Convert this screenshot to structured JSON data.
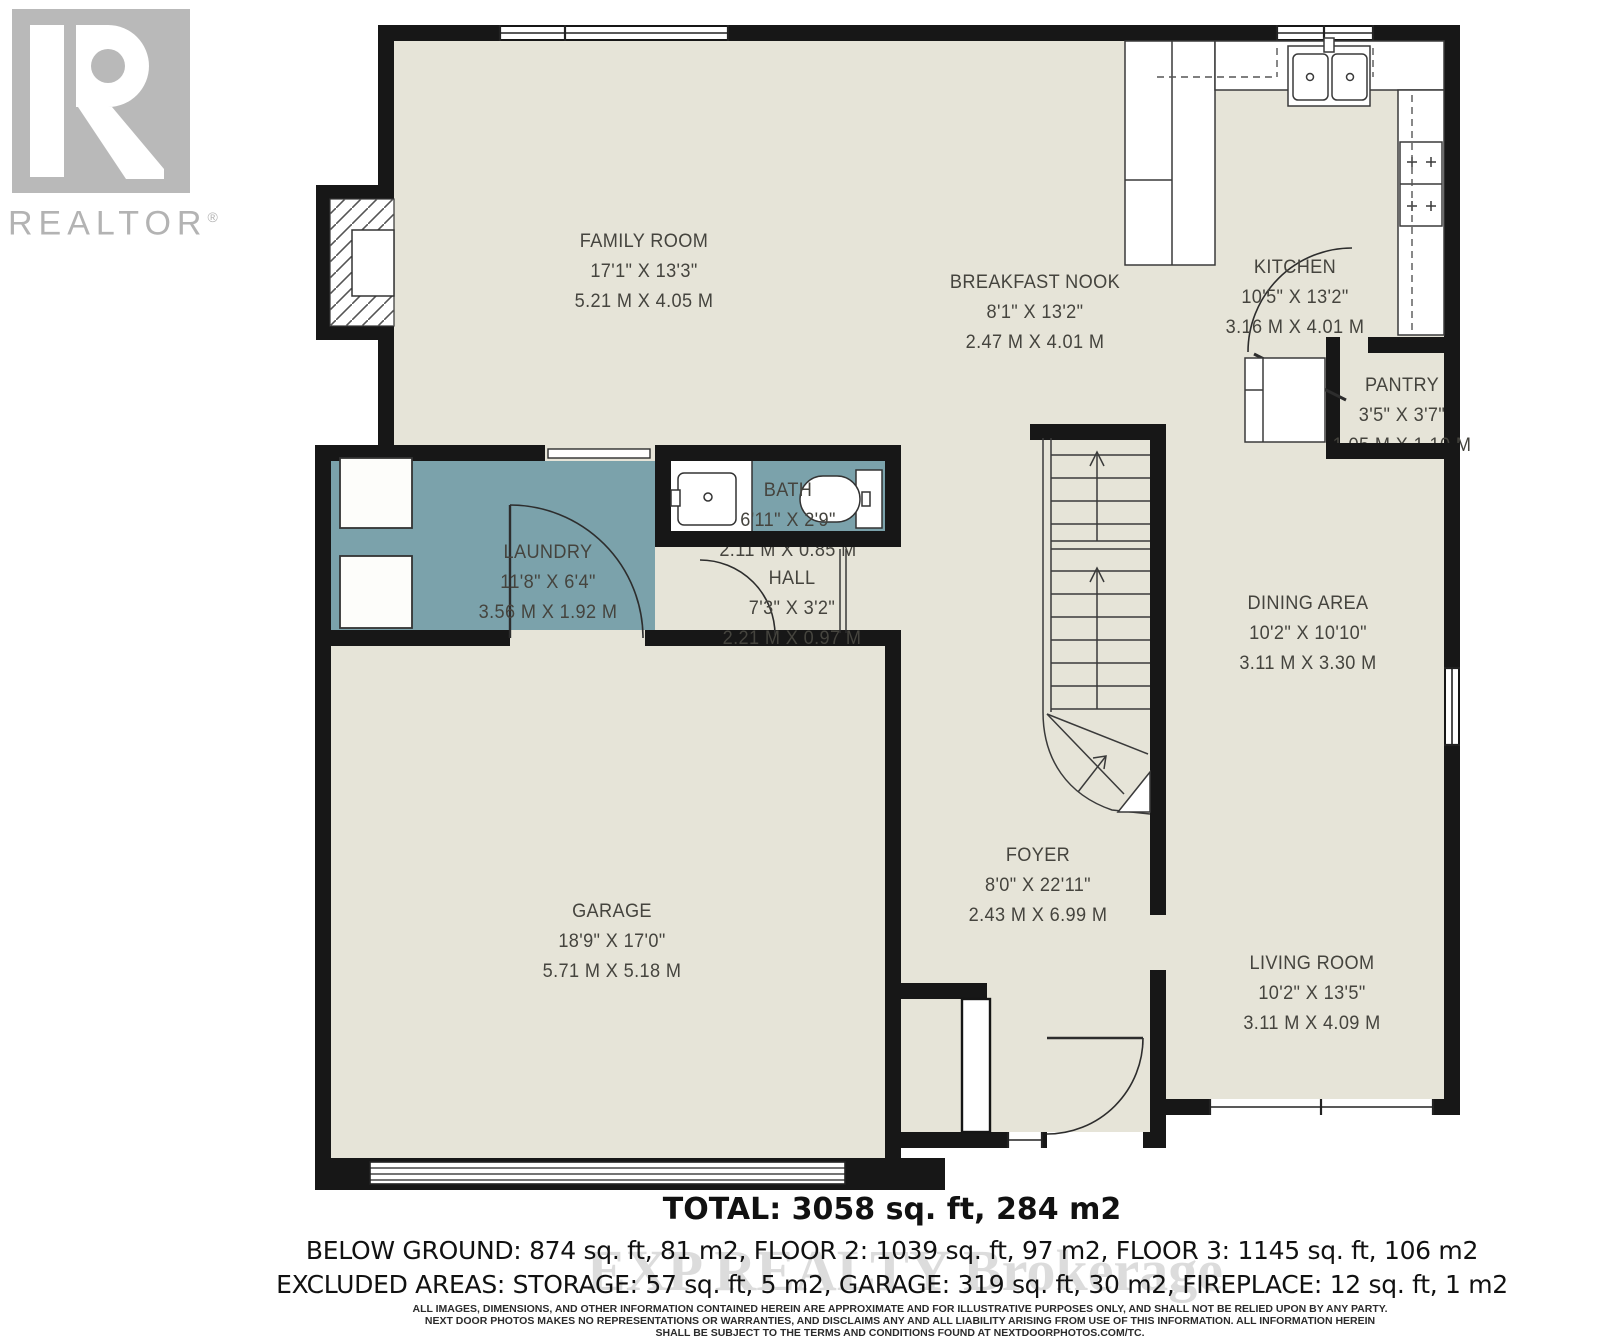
{
  "branding": {
    "logo_text": "REALTOR",
    "registered_mark": "®"
  },
  "watermark": "EXP REALTY Brokerage",
  "colors": {
    "room_fill": "#e6e4d8",
    "wet_room_fill": "#7ba2ab",
    "wall": "#171717",
    "label_text": "#45443e",
    "logo_gray": "#b9b9b9"
  },
  "rooms": [
    {
      "name": "FAMILY ROOM",
      "imperial": "17'1\" X 13'3\"",
      "metric": "5.21 M X 4.05 M"
    },
    {
      "name": "BREAKFAST NOOK",
      "imperial": "8'1\" X 13'2\"",
      "metric": "2.47 M X 4.01 M"
    },
    {
      "name": "KITCHEN",
      "imperial": "10'5\" X 13'2\"",
      "metric": "3.16 M X 4.01 M"
    },
    {
      "name": "PANTRY",
      "imperial": "3'5\" X 3'7\"",
      "metric": "1.05 M X 1.10 M"
    },
    {
      "name": "LAUNDRY",
      "imperial": "11'8\" X 6'4\"",
      "metric": "3.56 M X 1.92 M"
    },
    {
      "name": "BATH",
      "imperial": "6'11\" X 2'9\"",
      "metric": "2.11 M X 0.85 M"
    },
    {
      "name": "HALL",
      "imperial": "7'3\" X 3'2\"",
      "metric": "2.21 M X 0.97 M"
    },
    {
      "name": "DINING AREA",
      "imperial": "10'2\" X 10'10\"",
      "metric": "3.11 M X 3.30 M"
    },
    {
      "name": "GARAGE",
      "imperial": "18'9\" X 17'0\"",
      "metric": "5.71 M X 5.18 M"
    },
    {
      "name": "FOYER",
      "imperial": "8'0\" X 22'11\"",
      "metric": "2.43 M X 6.99 M"
    },
    {
      "name": "LIVING ROOM",
      "imperial": "10'2\" X 13'5\"",
      "metric": "3.11 M X 4.09 M"
    }
  ],
  "summary": {
    "total": "TOTAL: 3058 sq. ft, 284 m2",
    "line2": "BELOW GROUND: 874 sq. ft, 81 m2, FLOOR 2: 1039 sq. ft, 97 m2, FLOOR 3: 1145 sq. ft, 106 m2",
    "line3": "EXCLUDED AREAS: STORAGE: 57 sq. ft, 5 m2, GARAGE: 319 sq. ft, 30 m2, FIREPLACE: 12 sq. ft, 1 m2"
  },
  "disclaimer": {
    "line1": "ALL IMAGES, DIMENSIONS, AND OTHER INFORMATION CONTAINED HEREIN ARE APPROXIMATE AND FOR ILLUSTRATIVE PURPOSES ONLY, AND SHALL NOT BE RELIED UPON BY ANY PARTY.",
    "line2": "NEXT DOOR PHOTOS MAKES NO REPRESENTATIONS OR WARRANTIES, AND DISCLAIMS ANY AND ALL LIABILITY ARISING FROM USE OF THIS INFORMATION. ALL INFORMATION HEREIN",
    "line3": "SHALL BE SUBJECT TO THE TERMS AND CONDITIONS FOUND AT NEXTDOORPHOTOS.COM/TC."
  }
}
